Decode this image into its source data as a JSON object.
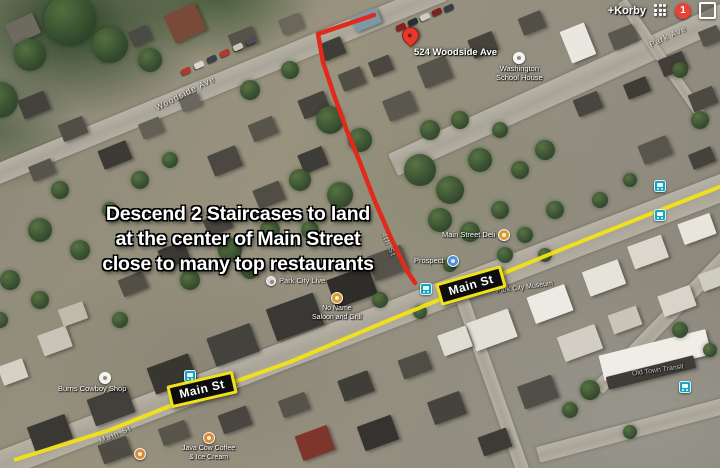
{
  "account_bar": {
    "user": "+Korby",
    "notification_count": "1"
  },
  "annotation": {
    "line1": "Descend 2 Staircases to land",
    "line2": "at the center of Main Street",
    "line3": "close to many top restaurants"
  },
  "destination_pin": {
    "label": "524 Woodside Ave"
  },
  "road_signs": {
    "sign1": "Main St",
    "sign2": "Main St"
  },
  "street_labels": {
    "woodside_ave": "Woodside Ave",
    "park_ave": "Park Ave",
    "main_st": "Main St",
    "fourth_st": "4th St"
  },
  "pois": {
    "washington_school": {
      "line1": "Washington",
      "line2": "School House"
    },
    "park_city_live": {
      "label": "Park City Live"
    },
    "main_street_deli": {
      "label": "Main Street Deli"
    },
    "prospect": {
      "label": "Prospect"
    },
    "park_city_museum": {
      "label": "Park City Museum"
    },
    "no_name_saloon": {
      "line1": "No Name",
      "line2": "Saloon and Grill"
    },
    "old_town_transit": {
      "label": "Old Town Transit"
    },
    "burns_cowboy_shop": {
      "label": "Burns Cowboy Shop"
    },
    "java_cow": {
      "line1": "Java Cow Coffee",
      "line2": "& Ice Cream"
    }
  },
  "colors": {
    "route": "#e02a1c",
    "main_st_highlight": "#f2e118",
    "sign_border": "#f0e11b",
    "notification_badge": "#e94335",
    "bus_icon": "#18a3c4",
    "pin": "#e6392c"
  }
}
